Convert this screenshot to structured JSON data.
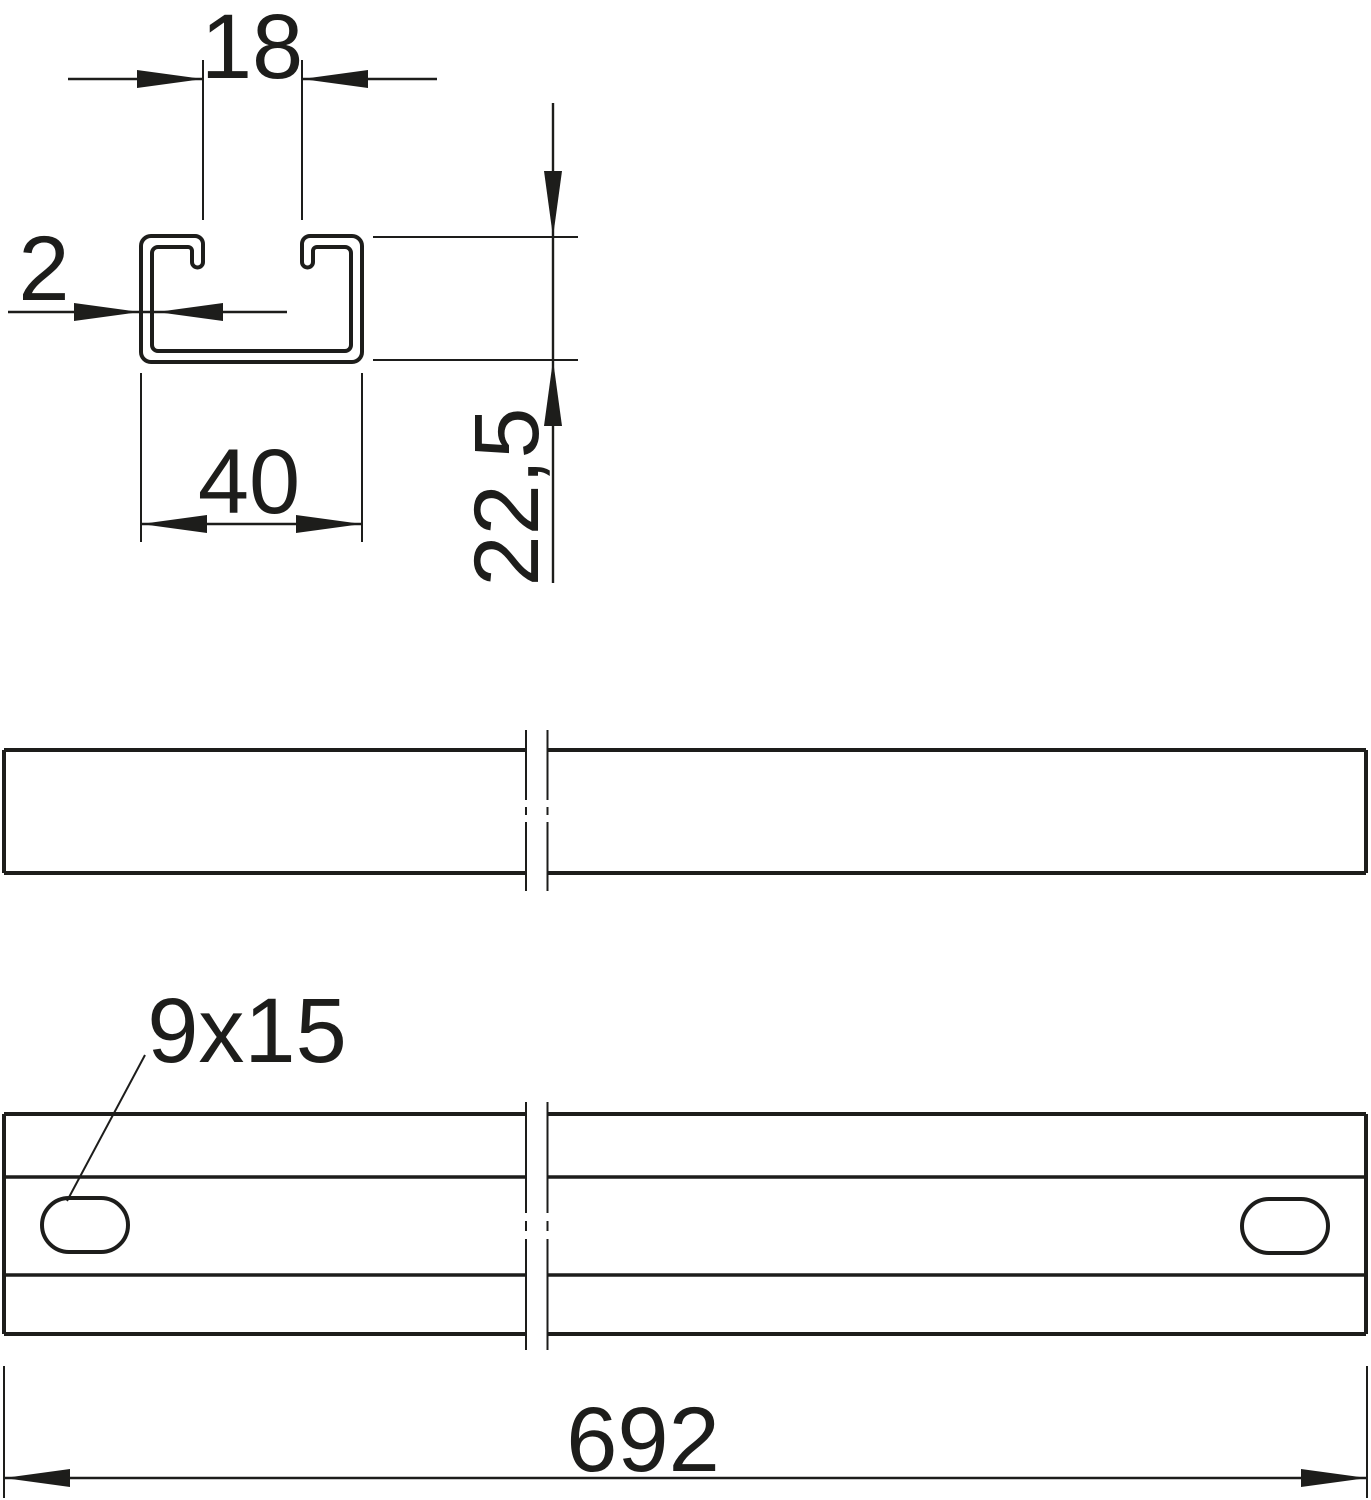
{
  "drawing": {
    "description": "Technical drawing of a C-profile mounting rail: cross-section, broken side view and broken plan view with slotted holes",
    "colors": {
      "line": "#1d1d1b",
      "background": "#ffffff"
    },
    "labels": {
      "opening_width": "18",
      "material_thickness": "2",
      "profile_width": "40",
      "profile_height": "22,5",
      "slot_size": "9x15",
      "rail_length": "692"
    }
  }
}
